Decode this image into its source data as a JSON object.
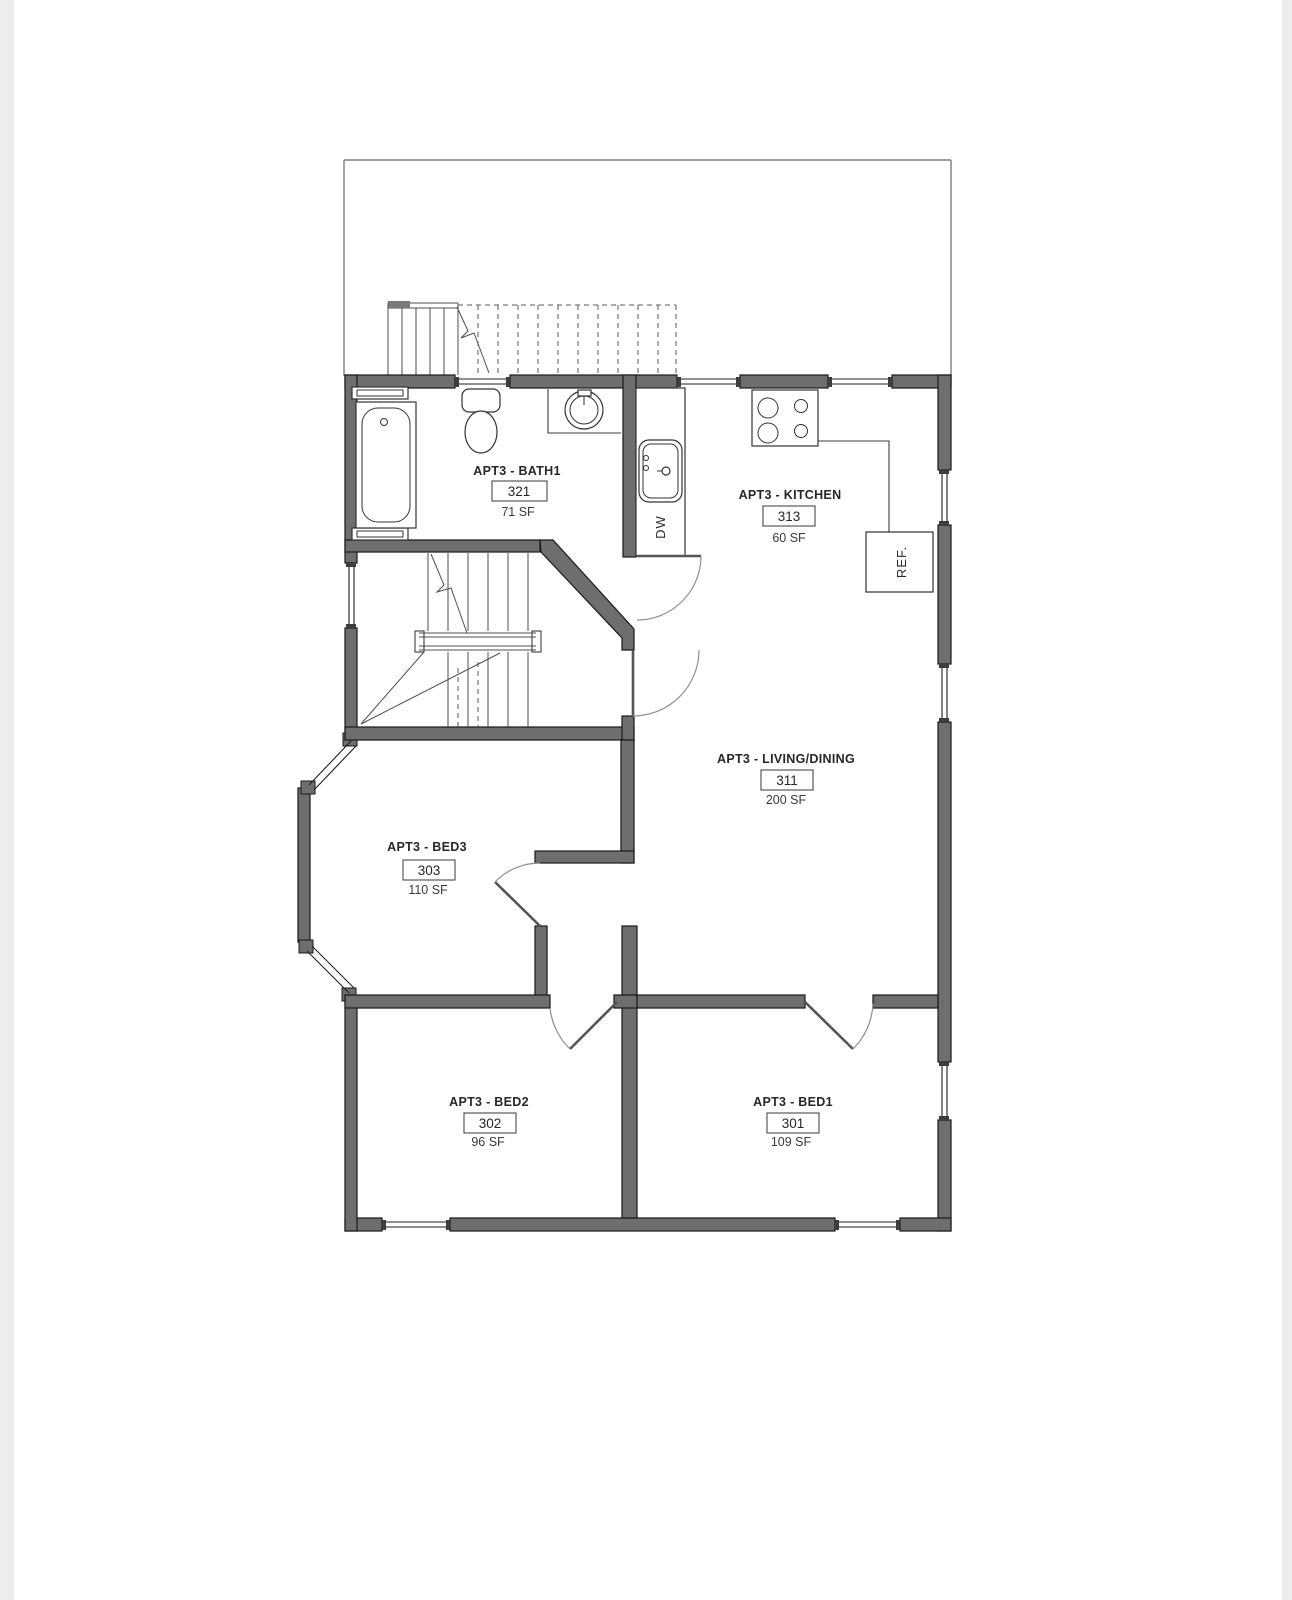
{
  "document": {
    "kind": "architectural floor plan",
    "unit": "APT3"
  },
  "rooms": [
    {
      "id": "bath1",
      "name": "APT3 - BATH1",
      "number": "321",
      "area": "71 SF"
    },
    {
      "id": "kitchen",
      "name": "APT3 - KITCHEN",
      "number": "313",
      "area": "60 SF"
    },
    {
      "id": "living",
      "name": "APT3 - LIVING/DINING",
      "number": "311",
      "area": "200 SF"
    },
    {
      "id": "bed3",
      "name": "APT3 - BED3",
      "number": "303",
      "area": "110 SF"
    },
    {
      "id": "bed2",
      "name": "APT3 - BED2",
      "number": "302",
      "area": "96 SF"
    },
    {
      "id": "bed1",
      "name": "APT3 - BED1",
      "number": "301",
      "area": "109 SF"
    }
  ],
  "appliances": {
    "dishwasher_label": "DW",
    "refrigerator_label": "REF."
  },
  "colors": {
    "wall_fill": "#6e6e6e",
    "wall_outline": "#191919",
    "line": "#3c3c3c",
    "sheet": "#ffffff",
    "background": "#ededed",
    "text": "#272727"
  }
}
